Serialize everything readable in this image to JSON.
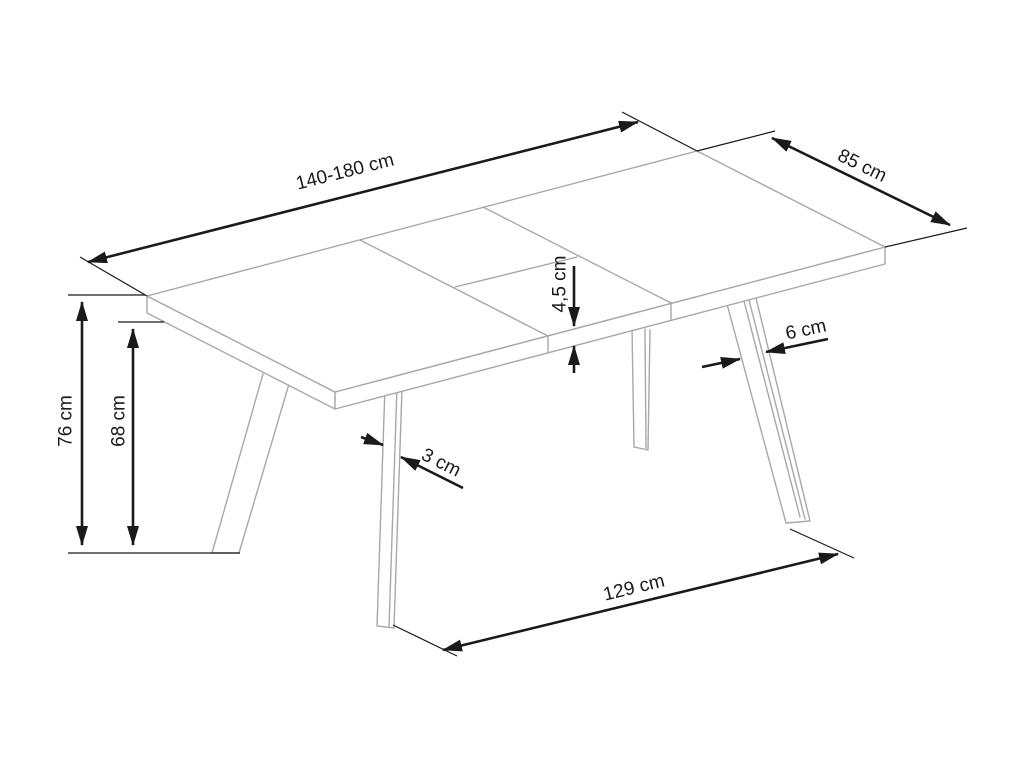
{
  "diagram": {
    "colors": {
      "background": "#ffffff",
      "furniture_outline": "#a8a8a8",
      "dimension_lines": "#1a1a1a"
    },
    "dimensions": {
      "length": "140-180 cm",
      "width": "85 cm",
      "height": "76 cm",
      "underside_clearance": "68 cm",
      "top_thickness": "4,5 cm",
      "leg_width": "6 cm",
      "leg_thickness": "3 cm",
      "feet_span": "129 cm"
    }
  }
}
